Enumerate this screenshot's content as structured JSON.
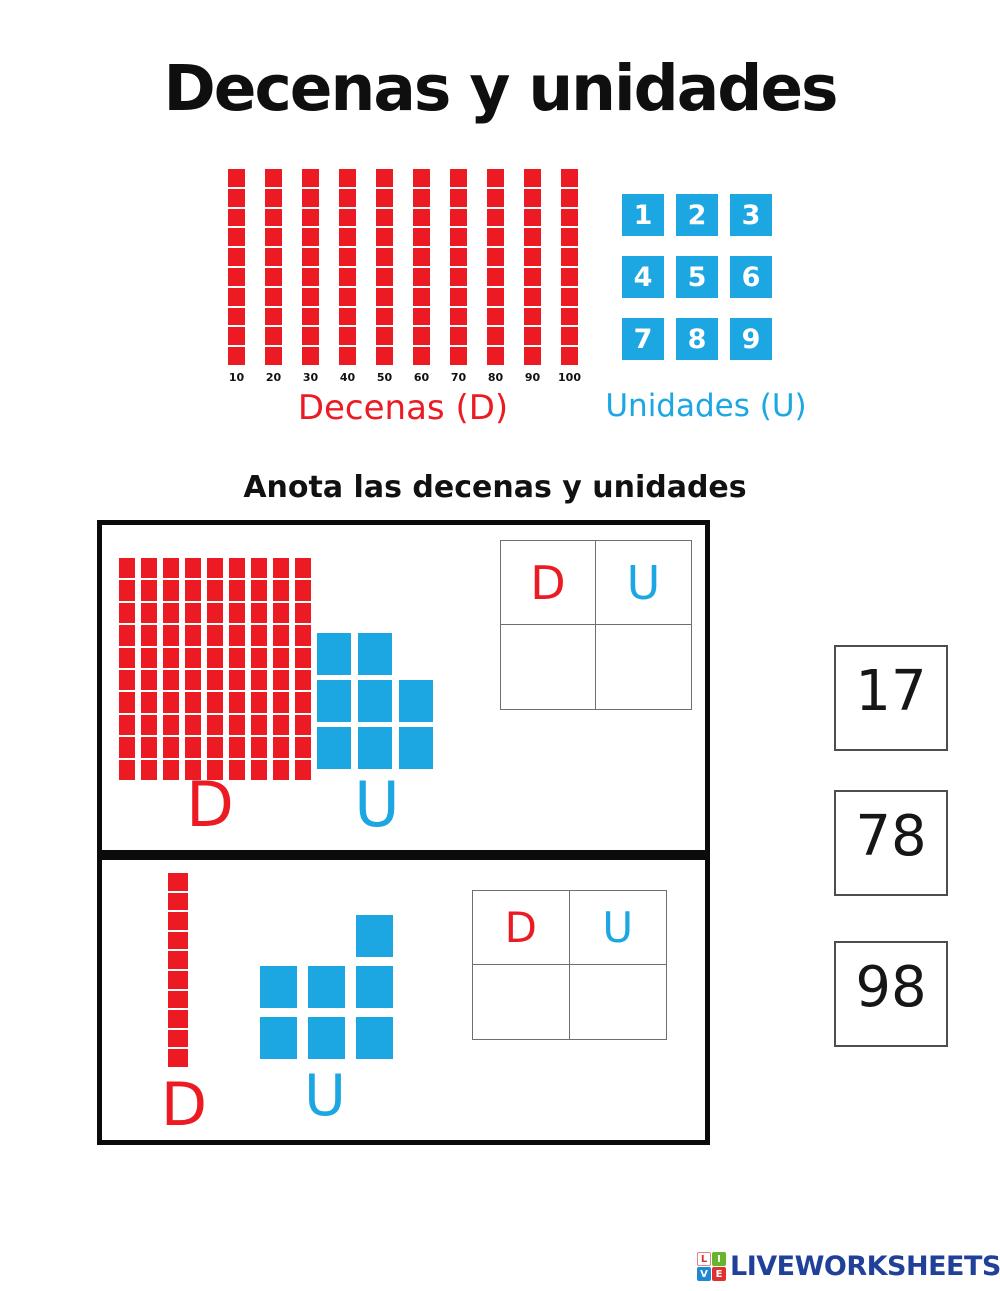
{
  "title": "Decenas y unidades",
  "instruction": "Anota las decenas y unidades",
  "colors": {
    "red": "#EC1B23",
    "blue": "#1CA6E2",
    "navy": "#21409A",
    "black": "#111111"
  },
  "legend": {
    "tens": {
      "label": "Decenas (D)",
      "bar_count": 10,
      "segments_per_bar": 10,
      "bar_labels": [
        "10",
        "20",
        "30",
        "40",
        "50",
        "60",
        "70",
        "80",
        "90",
        "100"
      ]
    },
    "units": {
      "label": "Unidades (U)",
      "numbers": [
        "1",
        "2",
        "3",
        "4",
        "5",
        "6",
        "7",
        "8",
        "9"
      ]
    }
  },
  "exercises": [
    {
      "bar_count": 9,
      "segments_per_bar": 10,
      "units_layout": [
        [
          1,
          1,
          0
        ],
        [
          1,
          1,
          1
        ],
        [
          1,
          1,
          1
        ]
      ],
      "tens_letter": "D",
      "units_letter": "U",
      "table": {
        "tens_header": "D",
        "units_header": "U",
        "tens_value": "",
        "units_value": ""
      }
    },
    {
      "bar_count": 1,
      "segments_per_bar": 10,
      "units_layout": [
        [
          0,
          0,
          1
        ],
        [
          1,
          1,
          1
        ],
        [
          1,
          1,
          1
        ]
      ],
      "tens_letter": "D",
      "units_letter": "U",
      "table": {
        "tens_header": "D",
        "units_header": "U",
        "tens_value": "",
        "units_value": ""
      }
    }
  ],
  "answer_cards": [
    "17",
    "78",
    "98"
  ],
  "footer": {
    "brand": "LIVEWORKSHEETS",
    "icon_letters": [
      "L",
      "I",
      "V",
      "E"
    ]
  }
}
